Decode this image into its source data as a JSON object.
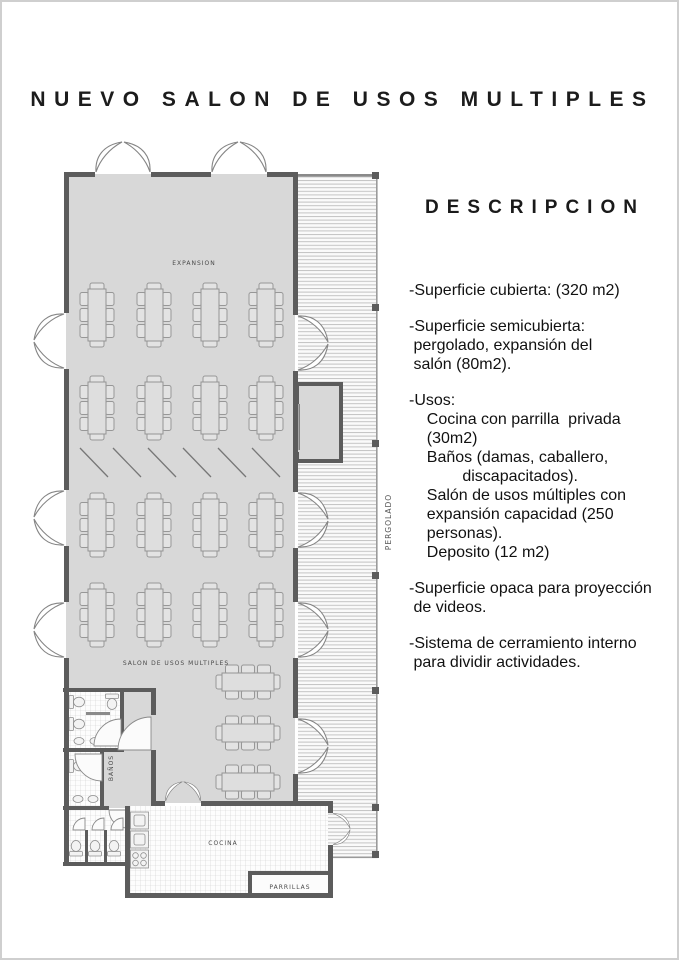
{
  "title": "NUEVO SALON DE USOS MULTIPLES",
  "description": {
    "heading": "DESCRIPCION",
    "items": [
      {
        "lines": [
          "-Superficie cubierta: (320 m2)"
        ]
      },
      {
        "lines": [
          "-Superficie semicubierta:",
          " pergolado, expansión del",
          " salón (80m2)."
        ]
      },
      {
        "lines": [
          "-Usos:",
          "    Cocina con parrilla  privada",
          "    (30m2)",
          "    Baños (damas, caballero,",
          "            discapacitados).",
          "    Salón de usos múltiples con",
          "    expansión capacidad (250",
          "    personas).",
          "    Deposito (12 m2)"
        ]
      },
      {
        "lines": [
          "-Superficie opaca para proyección",
          " de videos."
        ]
      },
      {
        "lines": [
          "-Sistema de cerramiento interno",
          " para dividir actividades."
        ]
      }
    ]
  },
  "plan": {
    "labels": {
      "expansion": "EXPANSION",
      "salon": "SALON DE USOS MULTIPLES",
      "banos": "BAÑOS",
      "cocina": "COCINA",
      "parrillas": "PARRILLAS",
      "pergolado": "PERGOLADO"
    },
    "colors": {
      "floor": "#d8d8d8",
      "wall": "#5c5c5c",
      "deck_line": "#c3c3c3",
      "tile_line": "#cfcfcf"
    }
  }
}
